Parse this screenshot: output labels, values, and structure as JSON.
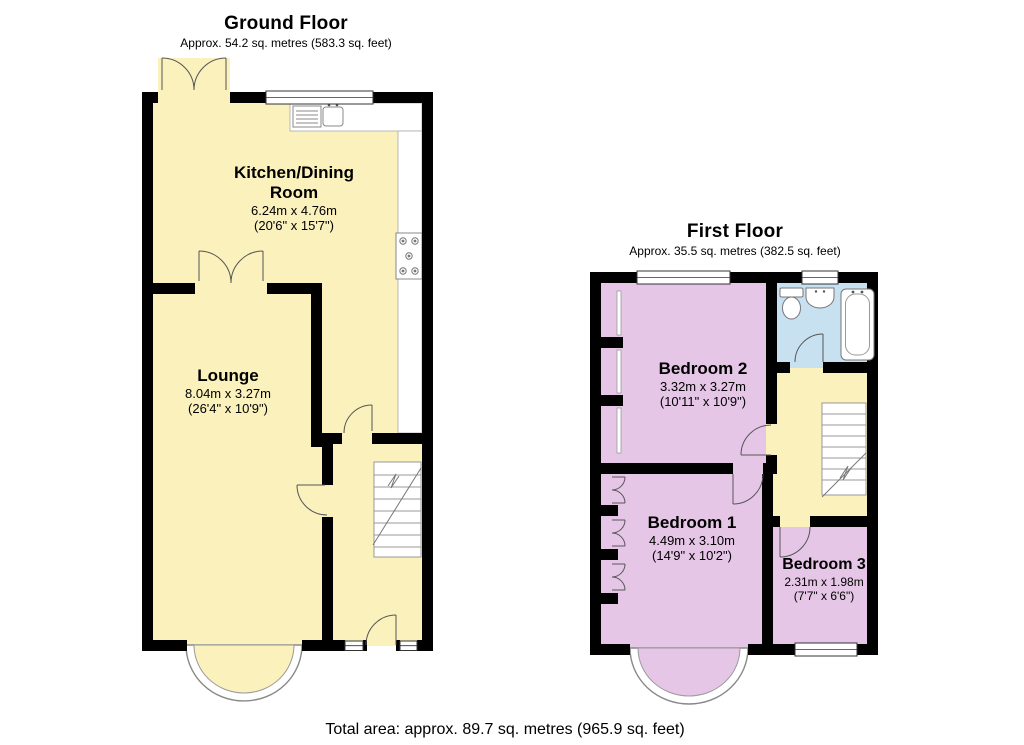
{
  "ground_floor": {
    "title": "Ground Floor",
    "subtitle": "Approx. 54.2 sq. metres (583.3 sq. feet)",
    "rooms": [
      {
        "name": "Kitchen/Dining Room",
        "metric": "6.24m x 4.76m",
        "imperial": "(20'6\" x 15'7\")"
      },
      {
        "name": "Lounge",
        "metric": "8.04m x 3.27m",
        "imperial": "(26'4\" x 10'9\")"
      }
    ]
  },
  "first_floor": {
    "title": "First Floor",
    "subtitle": "Approx. 35.5 sq. metres (382.5 sq. feet)",
    "rooms": [
      {
        "name": "Bedroom 2",
        "metric": "3.32m x 3.27m",
        "imperial": "(10'11\" x 10'9\")"
      },
      {
        "name": "Bedroom 1",
        "metric": "4.49m x 3.10m",
        "imperial": "(14'9\" x 10'2\")"
      },
      {
        "name": "Bedroom 3",
        "metric": "2.31m x 1.98m",
        "imperial": "(7'7\" x 6'6\")"
      }
    ]
  },
  "footer": {
    "total_area": "Total area: approx. 89.7 sq. metres (965.9 sq. feet)"
  },
  "colors": {
    "room_yellow": "#FAF1BC",
    "room_purple": "#E6C6E6",
    "bathroom_blue": "#C7E1F1",
    "wall": "#000000",
    "fixture_outline": "#777777"
  },
  "fixtures": [
    "kitchen-sink-icon",
    "hob-icon",
    "toilet-icon",
    "basin-icon",
    "bath-icon",
    "stairs-icon",
    "bay-window",
    "french-doors-icon",
    "door-swing-icon",
    "window-icon"
  ]
}
